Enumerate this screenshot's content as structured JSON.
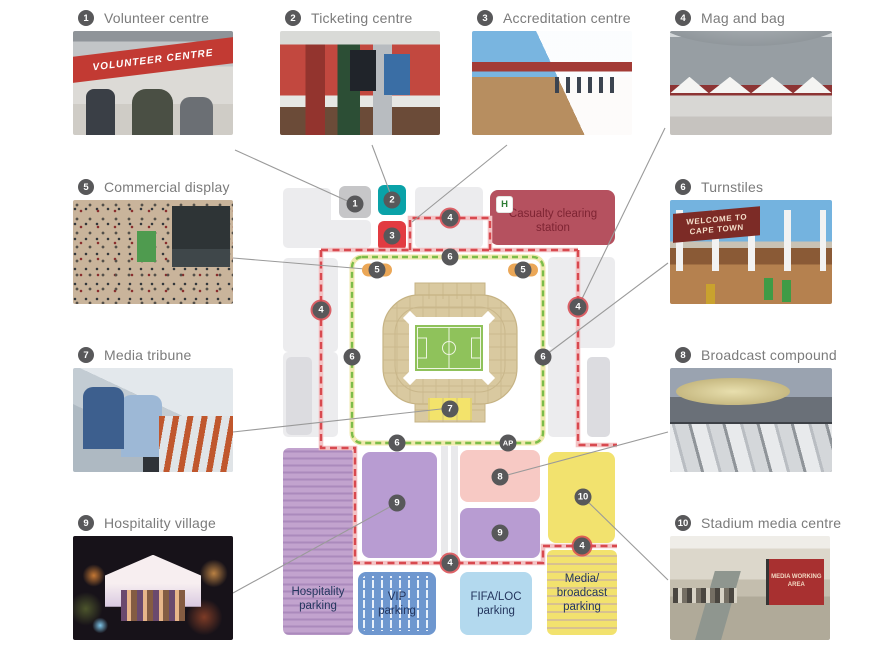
{
  "legend": {
    "items": [
      {
        "num": "1",
        "label": "Volunteer centre",
        "banner": "VOLUNTEER CENTRE"
      },
      {
        "num": "2",
        "label": "Ticketing centre"
      },
      {
        "num": "3",
        "label": "Accreditation centre"
      },
      {
        "num": "4",
        "label": "Mag and bag"
      },
      {
        "num": "5",
        "label": "Commercial display"
      },
      {
        "num": "6",
        "label": "Turnstiles",
        "banner_line1": "WELCOME TO",
        "banner_line2": "CAPE TOWN"
      },
      {
        "num": "7",
        "label": "Media tribune"
      },
      {
        "num": "8",
        "label": "Broadcast compound"
      },
      {
        "num": "9",
        "label": "Hospitality village"
      },
      {
        "num": "10",
        "label": "Stadium media centre",
        "sign": "MEDIA WORKING AREA"
      }
    ]
  },
  "map": {
    "markers": {
      "m1": "1",
      "m2": "2",
      "m3": "3",
      "m4": "4",
      "m5": "5",
      "m6": "6",
      "m7": "7",
      "m8": "8",
      "m9": "9",
      "m10": "10",
      "ap": "AP",
      "hospital": "H"
    },
    "labels": {
      "casualty": "Casualty clearing\nstation",
      "hospitality_parking": "Hospitality\nparking",
      "vip_parking": "VIP\nparking",
      "fifa_loc_parking": "FIFA/LOC\nparking",
      "media_parking": "Media/\nbroadcast\nparking"
    },
    "colors": {
      "outer_perimeter_red": "#d8494f",
      "inner_perimeter_green": "#7cbd4a",
      "casualty_box": "#b5515f",
      "ticketing_square": "#0aa2a8",
      "accreditation_square": "#e23b41",
      "volunteer_square": "#c6c6c8",
      "hospitality_zone": "#b89cd2",
      "hospitality_parking": "#c2a3ce",
      "broadcast_zone": "#f7c9c4",
      "media_centre_zone": "#f2e26e",
      "vip_parking": "#6e97cf",
      "fifa_loc_parking": "#b3d9ee",
      "stadium": "#d9c9a0",
      "pitch": "#8fc25b",
      "media_tribune": "#f3e36b",
      "marker": "#58585a",
      "commercial_display": "#eba757"
    }
  }
}
